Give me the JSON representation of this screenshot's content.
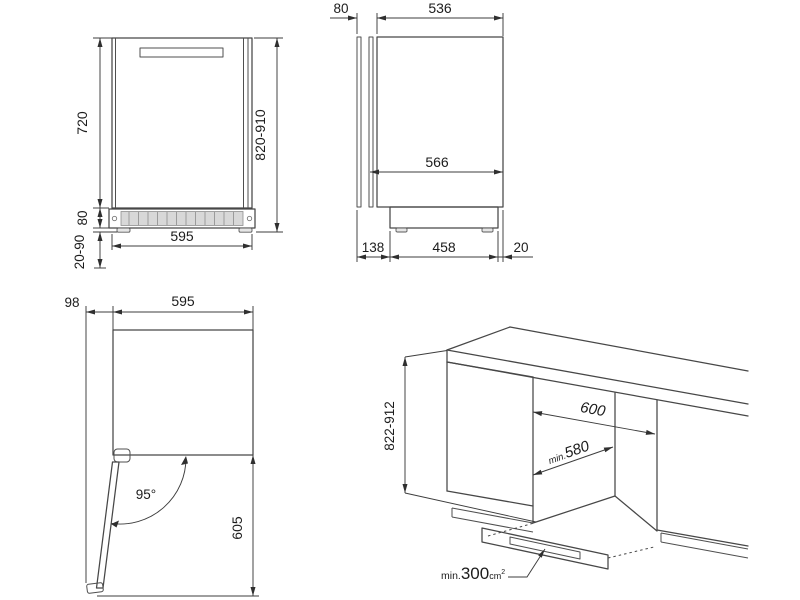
{
  "colors": {
    "line": "#474747",
    "text": "#1c1c1c",
    "grille_fill": "#d8d8d8"
  },
  "views": {
    "front": {
      "dims": {
        "door_height": "720",
        "plinth_height": "80",
        "feet_range": "20-90",
        "width": "595",
        "overall_height": "820-910"
      }
    },
    "side": {
      "dims": {
        "door_thickness": "80",
        "body_depth": "536",
        "overall_depth": "566",
        "front_clearance": "138",
        "base_length": "458",
        "rear_clearance": "20"
      }
    },
    "top": {
      "dims": {
        "door_projection": "98",
        "width": "595",
        "door_angle": "95°",
        "door_swing": "605"
      }
    },
    "install": {
      "dims": {
        "niche_height": "822-912",
        "niche_width": "600",
        "depth_prefix": "min.",
        "depth_value": "580",
        "vent_prefix": "min.",
        "vent_value": "300",
        "vent_unit": "cm",
        "vent_exp": "2"
      }
    }
  }
}
